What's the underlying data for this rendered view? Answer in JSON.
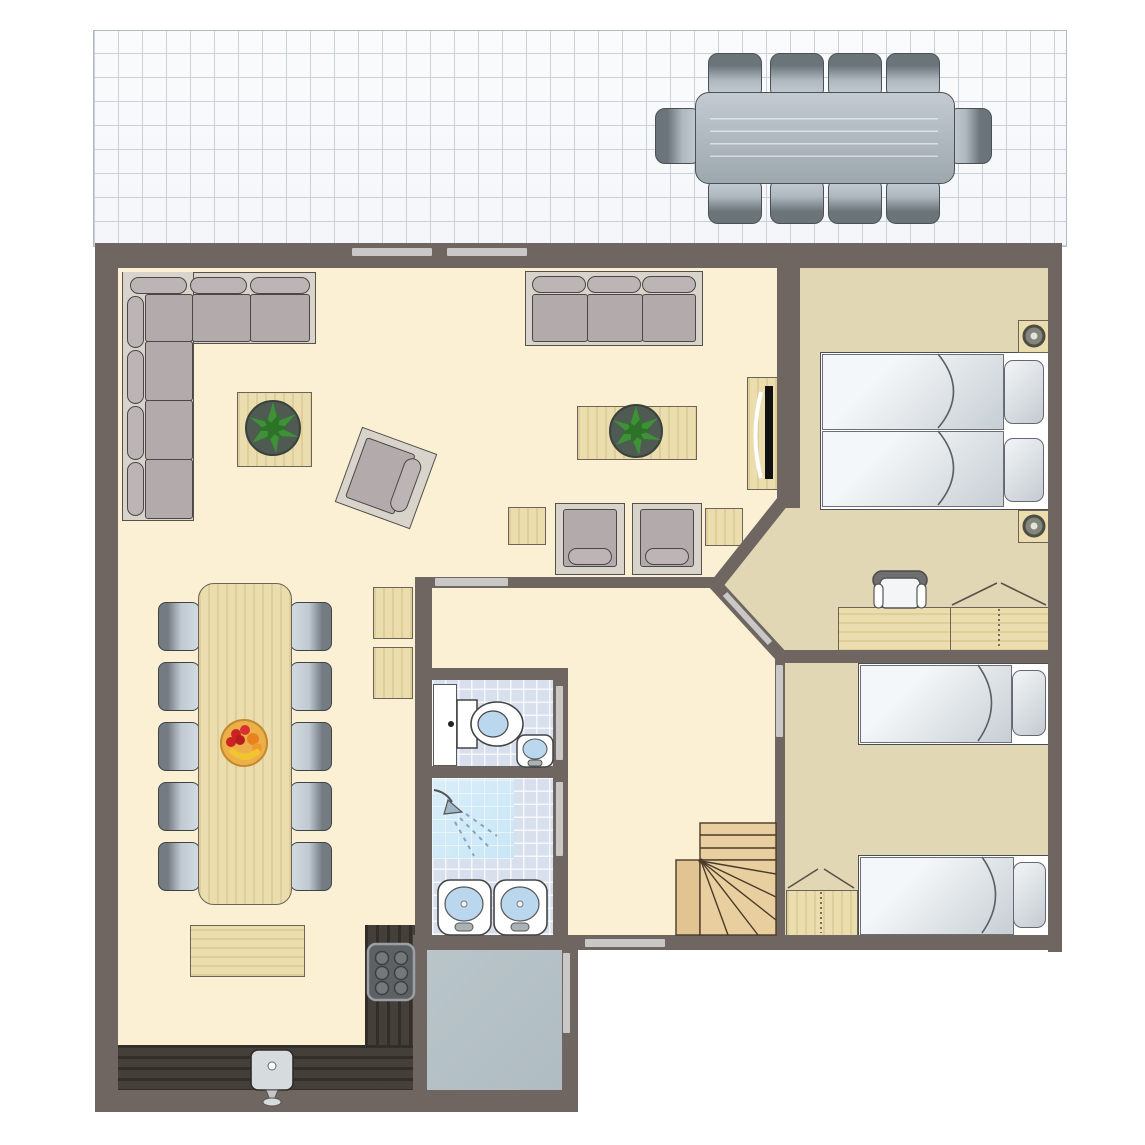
{
  "meta": {
    "kind": "holiday-home floor plan, top-down view",
    "canvas_w": 1145,
    "canvas_h": 1145,
    "visible_text": "none"
  },
  "palette": {
    "wall": "#6F6661",
    "floor_main": "#FBF0D3",
    "floor_bedroom": "#E1D7B5",
    "terrace_tile": "#FAFBFD",
    "terrace_grid": "#CAD0D9",
    "bath_tile": "#D8E0EE",
    "shower_tile": "#C9E6F6",
    "utility_floor": "#AFBCC1",
    "wood_light": "#EBDDAD",
    "stair_wood": "#E9CEA0",
    "kitchen_counter": "#453F3A",
    "sofa_gray": "#B3ABAB",
    "sofa_base": "#D8D4CB",
    "dining_chair": "#BFC9D2",
    "outdoor_gray": "#AEB8BF",
    "door_marker": "#C9C8C6",
    "bed_white": "#F7F9FA",
    "plant_green": "#3E9137",
    "fruit_bowl": "#EDB049",
    "stove_dark": "#5E6164"
  },
  "rooms": {
    "terrace": {
      "floor": "white grid tiles",
      "furniture": [
        "outdoor-dining-table",
        "10 outdoor chairs (4 top, 4 bottom, 1 left, 1 right)"
      ]
    },
    "living_room": {
      "floor": "cream",
      "furniture": [
        "corner-sofa",
        "three-seat-sofa",
        "tv-cabinet with tv",
        "plant-side-table",
        "plant-coffee-table",
        "rotated-armchair",
        "2 armchairs",
        "2 small side tables",
        "dining-table with fruit bowl",
        "10 dining chairs",
        "2 small wall tables",
        "sideboard"
      ]
    },
    "kitchen": {
      "floor": "cream with dark wood counters",
      "furniture": [
        "l-shaped-counter",
        "kitchen-sink",
        "stove 6 burners"
      ]
    },
    "toilet_room": {
      "floor": "blue tile",
      "furniture": [
        "toilet",
        "hand-sink",
        "white-cabinet"
      ]
    },
    "shower_room": {
      "floor": "blue tile",
      "furniture": [
        "shower-corner",
        "double-sinks"
      ]
    },
    "hallway": {
      "floor": "cream",
      "furniture": [
        "winder-staircase"
      ]
    },
    "utility_room": {
      "floor": "gray"
    },
    "bedroom_1": {
      "floor": "tan",
      "furniture": [
        "2 single beds joined",
        "2 nightstands with lamps",
        "desk",
        "desk-chair",
        "wardrobe"
      ]
    },
    "bedroom_2": {
      "floor": "tan",
      "furniture": [
        "2 single beds",
        "wardrobe"
      ]
    }
  },
  "doors": [
    "2 sliding terrace door panels (top wall)",
    "living-to-hall door",
    "bedroom-1 diagonal door",
    "bedroom-2 door",
    "toilet door",
    "shower-room door",
    "utility door",
    "front door (bottom)"
  ],
  "counts": {
    "outdoor_chairs": 10,
    "dining_chairs": 10,
    "beds": 4,
    "bathroom_sinks": 3,
    "kitchen_sink": 1,
    "plants": 2,
    "wardrobes": 3,
    "stove_burners": 6
  }
}
